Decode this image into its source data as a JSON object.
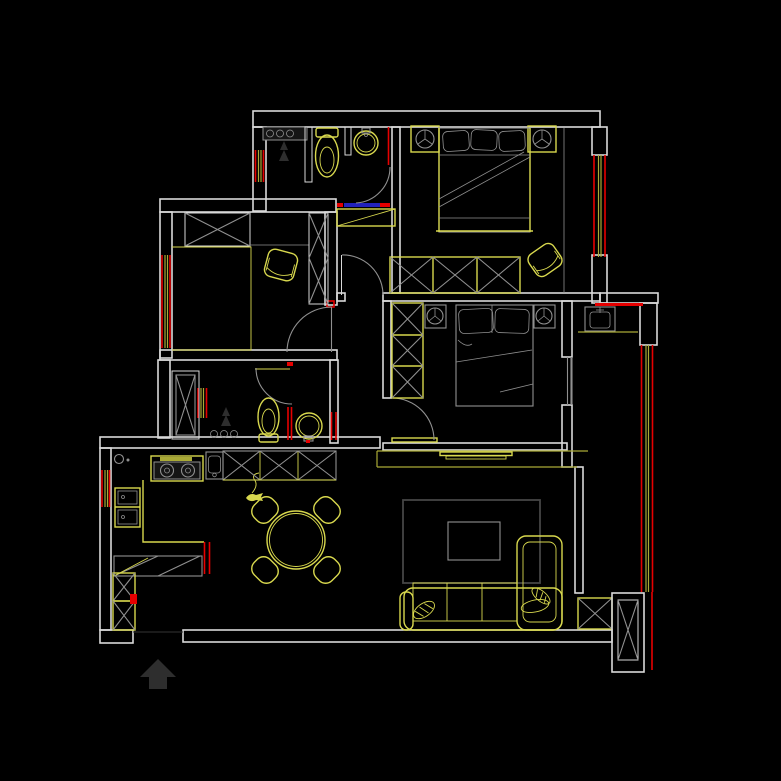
{
  "canvas": {
    "width": 781,
    "height": 781
  },
  "palette": {
    "background": "#000000",
    "wall": "#d9d9d9",
    "furniture": "#909090",
    "furniture_dark": "#454545",
    "cad_yellow": "#d8d84e",
    "window_yellow": "#aaaa36",
    "alert_red": "#e60000",
    "threshold_blue": "#2222bb",
    "symbol_dark": "#2e2e2e"
  },
  "drawing": {
    "type": "apartment-floor-plan",
    "style": "CAD line drawing on black background",
    "compass": {
      "symbol": "north-arrow",
      "direction": "up"
    }
  },
  "rooms": [
    {
      "name": "bathroom-top",
      "fixtures": [
        "shower-controls",
        "shower-head",
        "toilet",
        "wash-basin",
        "swing-door",
        "entry-threshold",
        "shoe-cabinet"
      ]
    },
    {
      "name": "master-bedroom",
      "fixtures": [
        "double-bed",
        "pillows",
        "nightstand-left",
        "nightstand-right",
        "lamps",
        "wardrobe-3-cells",
        "armchair",
        "window-right"
      ]
    },
    {
      "name": "study-bedroom",
      "fixtures": [
        "wardrobe",
        "tall-cabinet",
        "desk-bed",
        "desk-chair",
        "swing-door",
        "window-left"
      ]
    },
    {
      "name": "bathroom-middle",
      "fixtures": [
        "storage-cabinet",
        "shower-controls",
        "shower-head",
        "toilet",
        "round-basin",
        "swing-door",
        "partition-window"
      ]
    },
    {
      "name": "middle-bedroom",
      "fixtures": [
        "double-bed",
        "pillows",
        "nightstand-left",
        "nightstand-right",
        "wardrobe-3-cells",
        "swing-door",
        "sliding-window"
      ]
    },
    {
      "name": "kitchen",
      "fixtures": [
        "gas-meter",
        "cooktop-2-burners",
        "sink",
        "upper-cabinets-x",
        "refrigerator",
        "l-counter",
        "base-cabinets",
        "column-x-stack"
      ]
    },
    {
      "name": "dining-area",
      "fixtures": [
        "round-table",
        "chair-ne",
        "chair-nw",
        "chair-se",
        "chair-sw",
        "decor-symbol"
      ]
    },
    {
      "name": "living-room",
      "fixtures": [
        "tv-cabinet",
        "tv-panel",
        "rug",
        "coffee-table",
        "l-sofa",
        "chaise",
        "throw-pillows"
      ]
    },
    {
      "name": "balcony",
      "fixtures": [
        "laundry-basin",
        "counter-line",
        "drying-pole",
        "window-wall",
        "corner-column-x",
        "small-column-x"
      ]
    }
  ]
}
